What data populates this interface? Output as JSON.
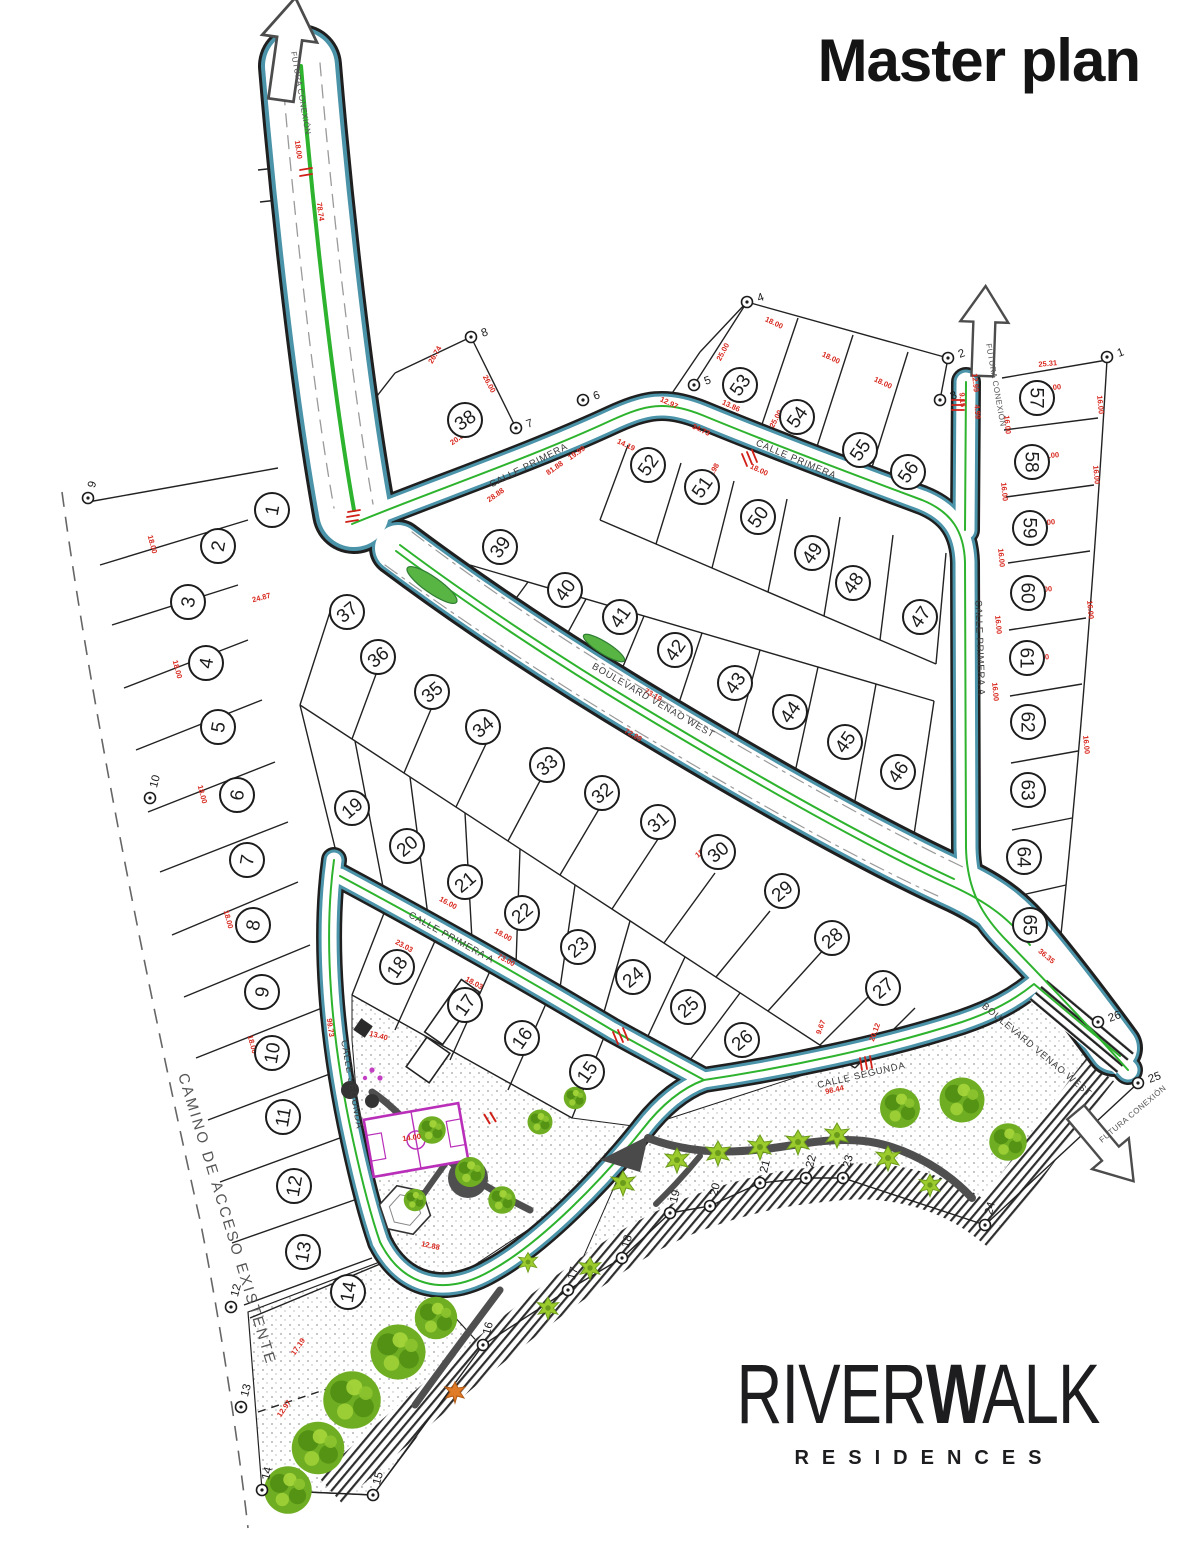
{
  "title": "Master plan",
  "brand": {
    "name_prefix": "RIVER",
    "name_bold_w": "W",
    "name_suffix": "ALK",
    "subtitle": "RESIDENCES"
  },
  "map_labels": {
    "access_road": "CAMINO DE ACCESO EXISTENTE",
    "future_connection": "FUTURA CONEXIÓN"
  },
  "streets": [
    {
      "name": "CALLE PRIMERA",
      "x": 530,
      "y": 468,
      "rot": -27
    },
    {
      "name": "CALLE PRIMERA",
      "x": 795,
      "y": 462,
      "rot": 23
    },
    {
      "name": "CALLE PRIMERA A",
      "x": 977,
      "y": 648,
      "rot": 88
    },
    {
      "name": "CALLE PRIMERA A",
      "x": 450,
      "y": 940,
      "rot": 29
    },
    {
      "name": "CALLE SEGUNDA",
      "x": 349,
      "y": 1085,
      "rot": 80
    },
    {
      "name": "CALLE SEGUNDA",
      "x": 862,
      "y": 1078,
      "rot": -13
    },
    {
      "name": "BOULEVARD VENAO WEST",
      "x": 652,
      "y": 703,
      "rot": 30
    },
    {
      "name": "BOULEVARD VENAO WEST",
      "x": 1035,
      "y": 1052,
      "rot": 40
    }
  ],
  "future_arrow_labels": [
    {
      "x": 291,
      "y": 52,
      "rot": 80
    },
    {
      "x": 986,
      "y": 344,
      "rot": 80
    },
    {
      "x": 1102,
      "y": 1143,
      "rot": -40
    }
  ],
  "lots": [
    {
      "n": "1",
      "x": 272,
      "y": 510,
      "r": -80
    },
    {
      "n": "2",
      "x": 218,
      "y": 546,
      "r": -80
    },
    {
      "n": "3",
      "x": 188,
      "y": 602,
      "r": -80
    },
    {
      "n": "4",
      "x": 206,
      "y": 663,
      "r": -80
    },
    {
      "n": "5",
      "x": 218,
      "y": 727,
      "r": -80
    },
    {
      "n": "6",
      "x": 237,
      "y": 795,
      "r": -80
    },
    {
      "n": "7",
      "x": 247,
      "y": 860,
      "r": -80
    },
    {
      "n": "8",
      "x": 253,
      "y": 925,
      "r": -80
    },
    {
      "n": "9",
      "x": 262,
      "y": 992,
      "r": -80
    },
    {
      "n": "10",
      "x": 272,
      "y": 1053,
      "r": -80
    },
    {
      "n": "11",
      "x": 283,
      "y": 1117,
      "r": -80
    },
    {
      "n": "12",
      "x": 294,
      "y": 1186,
      "r": -80
    },
    {
      "n": "13",
      "x": 303,
      "y": 1252,
      "r": -80
    },
    {
      "n": "14",
      "x": 348,
      "y": 1292,
      "r": -80
    },
    {
      "n": "15",
      "x": 587,
      "y": 1072,
      "r": -55
    },
    {
      "n": "16",
      "x": 522,
      "y": 1038,
      "r": -55
    },
    {
      "n": "17",
      "x": 465,
      "y": 1005,
      "r": -55
    },
    {
      "n": "18",
      "x": 397,
      "y": 967,
      "r": -55
    },
    {
      "n": "19",
      "x": 352,
      "y": 808,
      "r": -40
    },
    {
      "n": "20",
      "x": 407,
      "y": 846,
      "r": -40
    },
    {
      "n": "21",
      "x": 465,
      "y": 882,
      "r": -40
    },
    {
      "n": "22",
      "x": 522,
      "y": 913,
      "r": -40
    },
    {
      "n": "23",
      "x": 578,
      "y": 947,
      "r": -40
    },
    {
      "n": "24",
      "x": 633,
      "y": 977,
      "r": -40
    },
    {
      "n": "25",
      "x": 688,
      "y": 1007,
      "r": -40
    },
    {
      "n": "26",
      "x": 742,
      "y": 1040,
      "r": -40
    },
    {
      "n": "27",
      "x": 883,
      "y": 988,
      "r": -40
    },
    {
      "n": "28",
      "x": 832,
      "y": 938,
      "r": -40
    },
    {
      "n": "29",
      "x": 782,
      "y": 891,
      "r": -40
    },
    {
      "n": "30",
      "x": 718,
      "y": 852,
      "r": -40
    },
    {
      "n": "31",
      "x": 658,
      "y": 822,
      "r": -40
    },
    {
      "n": "32",
      "x": 602,
      "y": 793,
      "r": -40
    },
    {
      "n": "33",
      "x": 547,
      "y": 765,
      "r": -40
    },
    {
      "n": "34",
      "x": 483,
      "y": 727,
      "r": -40
    },
    {
      "n": "35",
      "x": 432,
      "y": 692,
      "r": -40
    },
    {
      "n": "36",
      "x": 378,
      "y": 657,
      "r": -40
    },
    {
      "n": "37",
      "x": 347,
      "y": 612,
      "r": -40
    },
    {
      "n": "38",
      "x": 465,
      "y": 420,
      "r": -35
    },
    {
      "n": "39",
      "x": 500,
      "y": 547,
      "r": -55
    },
    {
      "n": "40",
      "x": 565,
      "y": 590,
      "r": -55
    },
    {
      "n": "41",
      "x": 620,
      "y": 617,
      "r": -55
    },
    {
      "n": "42",
      "x": 675,
      "y": 650,
      "r": -55
    },
    {
      "n": "43",
      "x": 735,
      "y": 683,
      "r": -55
    },
    {
      "n": "44",
      "x": 790,
      "y": 712,
      "r": -55
    },
    {
      "n": "45",
      "x": 845,
      "y": 742,
      "r": -55
    },
    {
      "n": "46",
      "x": 898,
      "y": 772,
      "r": -55
    },
    {
      "n": "47",
      "x": 920,
      "y": 617,
      "r": -55
    },
    {
      "n": "48",
      "x": 853,
      "y": 583,
      "r": -55
    },
    {
      "n": "49",
      "x": 812,
      "y": 553,
      "r": -55
    },
    {
      "n": "50",
      "x": 758,
      "y": 517,
      "r": -55
    },
    {
      "n": "51",
      "x": 702,
      "y": 487,
      "r": -55
    },
    {
      "n": "52",
      "x": 648,
      "y": 465,
      "r": -55
    },
    {
      "n": "53",
      "x": 740,
      "y": 385,
      "r": -55
    },
    {
      "n": "54",
      "x": 797,
      "y": 417,
      "r": -55
    },
    {
      "n": "55",
      "x": 860,
      "y": 450,
      "r": -55
    },
    {
      "n": "56",
      "x": 908,
      "y": 472,
      "r": -55
    },
    {
      "n": "57",
      "x": 1037,
      "y": 398,
      "r": 90
    },
    {
      "n": "58",
      "x": 1032,
      "y": 462,
      "r": 90
    },
    {
      "n": "59",
      "x": 1030,
      "y": 528,
      "r": 90
    },
    {
      "n": "60",
      "x": 1028,
      "y": 593,
      "r": 90
    },
    {
      "n": "61",
      "x": 1027,
      "y": 658,
      "r": 90
    },
    {
      "n": "62",
      "x": 1028,
      "y": 722,
      "r": 90
    },
    {
      "n": "63",
      "x": 1028,
      "y": 790,
      "r": 90
    },
    {
      "n": "64",
      "x": 1024,
      "y": 857,
      "r": 90
    },
    {
      "n": "65",
      "x": 1030,
      "y": 925,
      "r": 90
    }
  ],
  "survey_points": [
    {
      "n": "1",
      "x": 1107,
      "y": 357,
      "r": -20
    },
    {
      "n": "2",
      "x": 948,
      "y": 358,
      "r": -20
    },
    {
      "n": "3",
      "x": 940,
      "y": 400,
      "r": -20
    },
    {
      "n": "4",
      "x": 747,
      "y": 302,
      "r": -20
    },
    {
      "n": "5",
      "x": 694,
      "y": 385,
      "r": -20
    },
    {
      "n": "6",
      "x": 583,
      "y": 400,
      "r": -20
    },
    {
      "n": "7",
      "x": 516,
      "y": 428,
      "r": -20
    },
    {
      "n": "8",
      "x": 471,
      "y": 337,
      "r": -20
    },
    {
      "n": "9",
      "x": 88,
      "y": 498,
      "r": -75
    },
    {
      "n": "10",
      "x": 150,
      "y": 798,
      "r": -75
    },
    {
      "n": "12",
      "x": 231,
      "y": 1307,
      "r": -75
    },
    {
      "n": "13",
      "x": 241,
      "y": 1407,
      "r": -75
    },
    {
      "n": "14",
      "x": 262,
      "y": 1490,
      "r": -75
    },
    {
      "n": "15",
      "x": 373,
      "y": 1495,
      "r": -75
    },
    {
      "n": "16",
      "x": 483,
      "y": 1345,
      "r": -75
    },
    {
      "n": "17",
      "x": 568,
      "y": 1290,
      "r": -75
    },
    {
      "n": "18",
      "x": 622,
      "y": 1258,
      "r": -75
    },
    {
      "n": "19",
      "x": 670,
      "y": 1213,
      "r": -75
    },
    {
      "n": "20",
      "x": 710,
      "y": 1206,
      "r": -75
    },
    {
      "n": "21",
      "x": 760,
      "y": 1183,
      "r": -75
    },
    {
      "n": "22",
      "x": 806,
      "y": 1178,
      "r": -75
    },
    {
      "n": "23",
      "x": 843,
      "y": 1178,
      "r": -75
    },
    {
      "n": "24",
      "x": 985,
      "y": 1225,
      "r": -75
    },
    {
      "n": "25",
      "x": 1138,
      "y": 1083,
      "r": -20
    },
    {
      "n": "26",
      "x": 1098,
      "y": 1022,
      "r": -20
    }
  ],
  "dimensions": [
    {
      "t": "78.74",
      "x": 318,
      "y": 212,
      "r": 82
    },
    {
      "t": "18.00",
      "x": 296,
      "y": 150,
      "r": 82
    },
    {
      "t": "26.74",
      "x": 437,
      "y": 356,
      "r": -60
    },
    {
      "t": "26.00",
      "x": 487,
      "y": 385,
      "r": 62
    },
    {
      "t": "20.83",
      "x": 460,
      "y": 440,
      "r": -35
    },
    {
      "t": "81.88",
      "x": 556,
      "y": 470,
      "r": -35
    },
    {
      "t": "28.88",
      "x": 497,
      "y": 497,
      "r": -35
    },
    {
      "t": "19.99",
      "x": 578,
      "y": 455,
      "r": -35
    },
    {
      "t": "14.19",
      "x": 625,
      "y": 447,
      "r": 25
    },
    {
      "t": "12.97",
      "x": 668,
      "y": 405,
      "r": 25
    },
    {
      "t": "34.73",
      "x": 700,
      "y": 432,
      "r": 25
    },
    {
      "t": "13.86",
      "x": 730,
      "y": 408,
      "r": 25
    },
    {
      "t": "25.00",
      "x": 725,
      "y": 353,
      "r": -62
    },
    {
      "t": "18.00",
      "x": 773,
      "y": 325,
      "r": 25
    },
    {
      "t": "18.00",
      "x": 830,
      "y": 360,
      "r": 25
    },
    {
      "t": "25.00",
      "x": 778,
      "y": 420,
      "r": -62
    },
    {
      "t": "18.00",
      "x": 882,
      "y": 385,
      "r": 25
    },
    {
      "t": "11.98",
      "x": 715,
      "y": 473,
      "r": -62
    },
    {
      "t": "18.00",
      "x": 758,
      "y": 472,
      "r": 25
    },
    {
      "t": "25.31",
      "x": 1048,
      "y": 366,
      "r": -5
    },
    {
      "t": "12.99",
      "x": 973,
      "y": 383,
      "r": 85
    },
    {
      "t": "9.15",
      "x": 960,
      "y": 400,
      "r": 85
    },
    {
      "t": "4.99",
      "x": 975,
      "y": 412,
      "r": 85
    },
    {
      "t": "25.00",
      "x": 1052,
      "y": 390,
      "r": -5
    },
    {
      "t": "16.00",
      "x": 1005,
      "y": 425,
      "r": 85
    },
    {
      "t": "16.00",
      "x": 1098,
      "y": 405,
      "r": 85
    },
    {
      "t": "25.00",
      "x": 1050,
      "y": 458,
      "r": -5
    },
    {
      "t": "16.00",
      "x": 1002,
      "y": 492,
      "r": 85
    },
    {
      "t": "25.00",
      "x": 1046,
      "y": 525,
      "r": -5
    },
    {
      "t": "16.00",
      "x": 1094,
      "y": 475,
      "r": 85
    },
    {
      "t": "25.00",
      "x": 1043,
      "y": 592,
      "r": -5
    },
    {
      "t": "16.00",
      "x": 999,
      "y": 558,
      "r": 85
    },
    {
      "t": "25.00",
      "x": 1040,
      "y": 660,
      "r": -5
    },
    {
      "t": "16.00",
      "x": 996,
      "y": 625,
      "r": 85
    },
    {
      "t": "25.00",
      "x": 1037,
      "y": 726,
      "r": -5
    },
    {
      "t": "16.00",
      "x": 1088,
      "y": 610,
      "r": 85
    },
    {
      "t": "25.00",
      "x": 1034,
      "y": 793,
      "r": -5
    },
    {
      "t": "16.00",
      "x": 993,
      "y": 692,
      "r": 85
    },
    {
      "t": "16.00",
      "x": 1084,
      "y": 745,
      "r": 85
    },
    {
      "t": "73.19",
      "x": 652,
      "y": 697,
      "r": 30
    },
    {
      "t": "72.99",
      "x": 632,
      "y": 737,
      "r": 30
    },
    {
      "t": "73.00",
      "x": 505,
      "y": 962,
      "r": 29
    },
    {
      "t": "23.03",
      "x": 403,
      "y": 948,
      "r": 29
    },
    {
      "t": "16.00",
      "x": 447,
      "y": 905,
      "r": 29
    },
    {
      "t": "18.00",
      "x": 502,
      "y": 937,
      "r": 29
    },
    {
      "t": "18.03",
      "x": 473,
      "y": 985,
      "r": 29
    },
    {
      "t": "98.44",
      "x": 835,
      "y": 1092,
      "r": -13
    },
    {
      "t": "20.12",
      "x": 877,
      "y": 1033,
      "r": -70
    },
    {
      "t": "9.67",
      "x": 823,
      "y": 1028,
      "r": -70
    },
    {
      "t": "18.00",
      "x": 150,
      "y": 545,
      "r": 75
    },
    {
      "t": "18.00",
      "x": 175,
      "y": 670,
      "r": 75
    },
    {
      "t": "18.00",
      "x": 200,
      "y": 795,
      "r": 75
    },
    {
      "t": "18.00",
      "x": 226,
      "y": 920,
      "r": 75
    },
    {
      "t": "18.00",
      "x": 250,
      "y": 1045,
      "r": 75
    },
    {
      "t": "24.87",
      "x": 262,
      "y": 600,
      "r": -15
    },
    {
      "t": "99.73",
      "x": 328,
      "y": 1028,
      "r": 82
    },
    {
      "t": "13.40",
      "x": 378,
      "y": 1038,
      "r": 15
    },
    {
      "t": "14.00",
      "x": 412,
      "y": 1140,
      "r": -8
    },
    {
      "t": "12.88",
      "x": 430,
      "y": 1248,
      "r": 12
    },
    {
      "t": "17.19",
      "x": 300,
      "y": 1348,
      "r": -55
    },
    {
      "t": "12.97",
      "x": 286,
      "y": 1410,
      "r": -55
    },
    {
      "t": "36.35",
      "x": 1045,
      "y": 958,
      "r": 40
    },
    {
      "t": "16.00",
      "x": 545,
      "y": 758,
      "r": -40
    },
    {
      "t": "18.00",
      "x": 598,
      "y": 790,
      "r": -40
    },
    {
      "t": "16.00",
      "x": 652,
      "y": 822,
      "r": -40
    },
    {
      "t": "18.00",
      "x": 705,
      "y": 852,
      "r": -40
    }
  ],
  "colors": {
    "ink": "#1c1c1c",
    "road_edge_teal": "#4a93a8",
    "centerline_green": "#2db32d",
    "dimension_red": "#d8281e",
    "tree_green": "#76b42a",
    "tree_green_dark": "#4e8c12",
    "court_magenta": "#b92fb9",
    "path_gray": "#4f4f4f"
  }
}
